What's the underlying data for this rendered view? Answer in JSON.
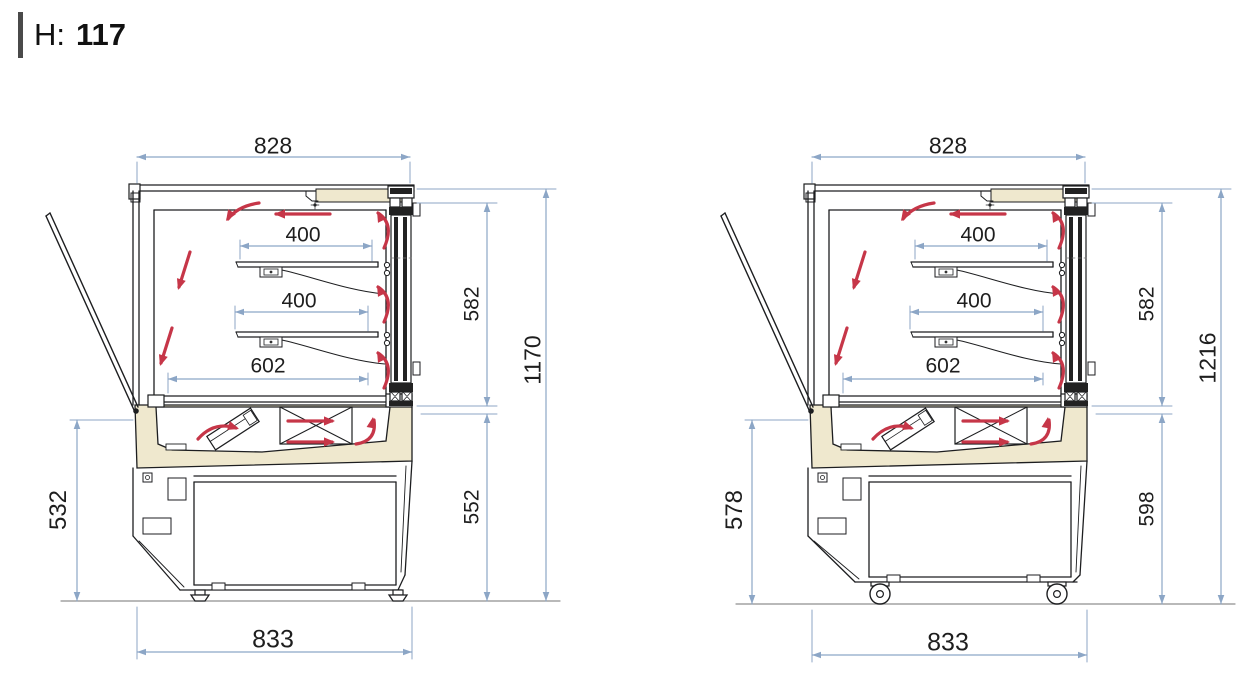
{
  "title": {
    "label": "H:",
    "value": "117"
  },
  "colors": {
    "outline": "#1d1e20",
    "dimension": "#8ca6c6",
    "dimension_text": "#1e1e1e",
    "airflow_arrow": "#c63648",
    "panel_cream": "#efe8ce",
    "glass_dark": "#222222",
    "ground": "#8f8f8f",
    "background": "#ffffff",
    "title_bar": "#4a4a4a"
  },
  "views": [
    {
      "id": "display-case-on-feet",
      "base_type": "feet",
      "dimensions": {
        "top_width": "828",
        "upper_shelf_depth": "400",
        "lower_shelf_depth": "400",
        "base_depth": "602",
        "display_height": "582",
        "lower_height": "552",
        "total_height": "1170",
        "left_height": "532",
        "overall_width": "833"
      }
    },
    {
      "id": "display-case-on-casters",
      "base_type": "casters",
      "dimensions": {
        "top_width": "828",
        "upper_shelf_depth": "400",
        "lower_shelf_depth": "400",
        "base_depth": "602",
        "display_height": "582",
        "lower_height": "598",
        "total_height": "1216",
        "left_height": "578",
        "overall_width": "833"
      }
    }
  ]
}
